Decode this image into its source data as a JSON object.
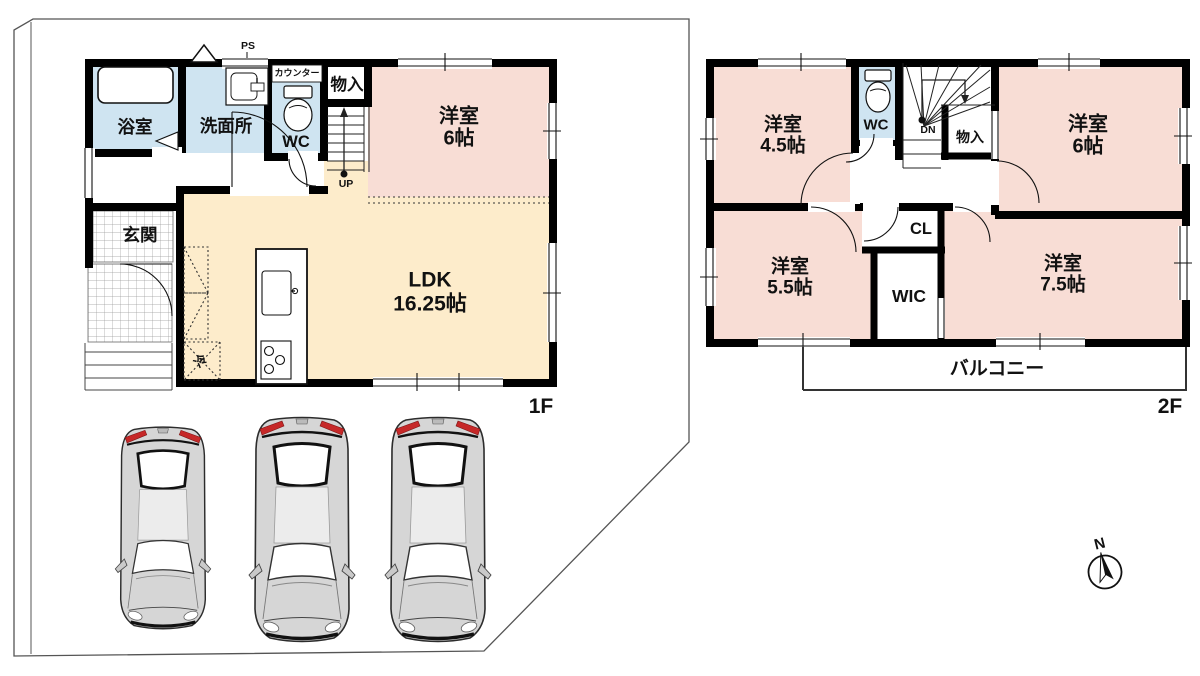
{
  "floor1": {
    "label": "1F",
    "bath": "浴室",
    "washroom": "洗面所",
    "wc": "WC",
    "counter": "カウンター",
    "ps": "PS",
    "storage": "物入",
    "up": "UP",
    "western6": {
      "name": "洋室",
      "size": "6帖"
    },
    "ldk": {
      "name": "LDK",
      "size": "16.25帖"
    },
    "entrance": "玄関",
    "fridge": "冷"
  },
  "floor2": {
    "label": "2F",
    "western45": {
      "name": "洋室",
      "size": "4.5帖"
    },
    "wc": "WC",
    "dn": "DN",
    "storage": "物入",
    "western6": {
      "name": "洋室",
      "size": "6帖"
    },
    "closet": "CL",
    "wic": "WIC",
    "western55": {
      "name": "洋室",
      "size": "5.5帖"
    },
    "western75": {
      "name": "洋室",
      "size": "7.5帖"
    },
    "balcony": "バルコニー"
  },
  "compass": {
    "north": "N"
  },
  "colors": {
    "room_pink": "#f8ddd5",
    "room_cream": "#fdeccb",
    "room_blue": "#cfe4f1",
    "wall": "#000000",
    "tail_light_red": "#c62828",
    "car_body_gray": "#d6d6d6"
  }
}
